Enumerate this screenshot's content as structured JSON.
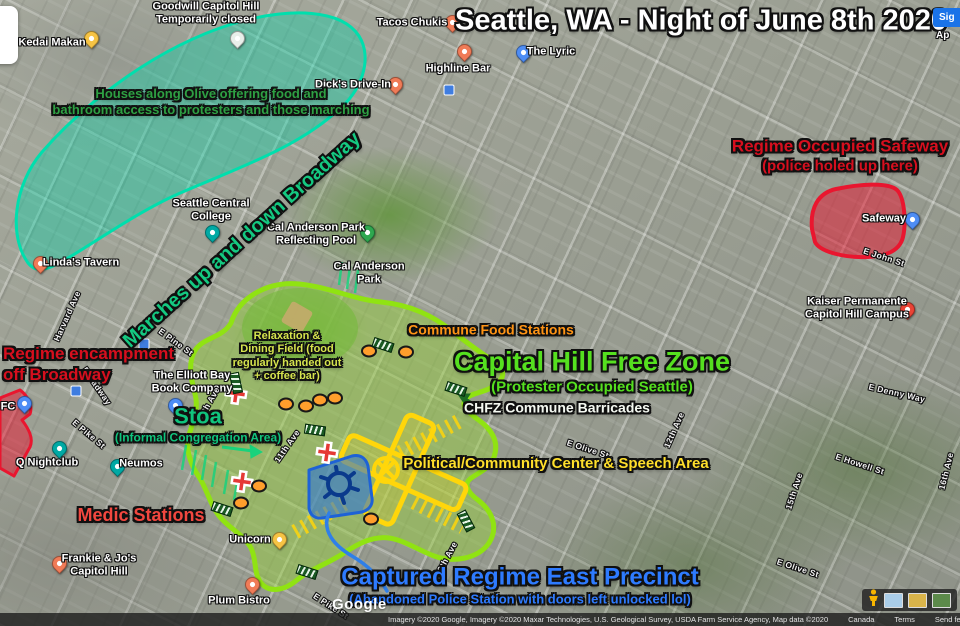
{
  "chrome": {
    "sign_in": "Sig",
    "apps": "Ap"
  },
  "footer": {
    "logo": "Google",
    "attribution": "Imagery ©2020 Google, Imagery ©2020 Maxar Technologies, U.S. Geological Survey, USDA Farm Service Agency, Map data ©2020",
    "region": "Canada",
    "terms": "Terms",
    "feedback": "Send feedback",
    "scale": "50 m"
  },
  "annotations": [
    {
      "id": "main-title",
      "lines": [
        "Seattle, WA - Night of June 8th 2020"
      ],
      "color": "#ffffff",
      "x": 701,
      "y": 21,
      "size": 29,
      "align": "center"
    },
    {
      "id": "houses-olive",
      "lines": [
        "Houses along Olive offering food and",
        "bathroom access to protesters and those marching"
      ],
      "color": "#2ea043",
      "x": 211,
      "y": 102,
      "size": 13,
      "align": "center"
    },
    {
      "id": "marches-broadway",
      "lines": [
        "Marches up and down Broadway"
      ],
      "color": "#14c981",
      "x": 242,
      "y": 240,
      "size": 20,
      "align": "center",
      "rotate": -42
    },
    {
      "id": "regime-safeway",
      "lines": [
        "Regime Occupied Safeway",
        "(police holed up here)"
      ],
      "color": "#d70f1e",
      "x": 840,
      "y": 156,
      "size": 17,
      "size2": 15,
      "align": "center"
    },
    {
      "id": "regime-encampment",
      "lines": [
        "Regime encampment",
        "off Broadway"
      ],
      "color": "#d70f1e",
      "x": 3,
      "y": 344,
      "size": 17,
      "align": "left"
    },
    {
      "id": "chfz-title",
      "lines": [
        "Capital Hill Free Zone",
        "(Protester Occupied Seattle)"
      ],
      "color": "#55e01f",
      "x": 592,
      "y": 371,
      "size": 27,
      "size2": 15,
      "align": "center"
    },
    {
      "id": "commune-food",
      "lines": [
        "Commune Food Stations"
      ],
      "color": "#ff9415",
      "x": 491,
      "y": 330,
      "size": 14,
      "align": "center"
    },
    {
      "id": "chfz-barricades",
      "lines": [
        "CHFZ Commune Barricades"
      ],
      "color": "#f5f9f2",
      "x": 557,
      "y": 408,
      "size": 14,
      "align": "center"
    },
    {
      "id": "relaxation-field",
      "lines": [
        "Relaxation &",
        "Dining Field (food",
        "regularly handed out",
        "+ coffee bar)"
      ],
      "color": "#d6e44e",
      "x": 287,
      "y": 357,
      "size": 11,
      "align": "center"
    },
    {
      "id": "stoa",
      "lines": [
        "Stoa",
        "(Informal Congregation Area)"
      ],
      "color": "#10c47d",
      "x": 198,
      "y": 424,
      "size": 22,
      "size2": 12,
      "align": "center"
    },
    {
      "id": "medic-stations",
      "lines": [
        "Medic Stations"
      ],
      "color": "#f2473f",
      "x": 141,
      "y": 516,
      "size": 18,
      "align": "center"
    },
    {
      "id": "speech-area",
      "lines": [
        "Political/Community Center & Speech Area"
      ],
      "color": "#ffdf2b",
      "x": 556,
      "y": 464,
      "size": 15,
      "align": "center"
    },
    {
      "id": "captured-precinct",
      "lines": [
        "Captured Regime East Precinct",
        "(Abandoned Police Station with doors left unlocked lol)"
      ],
      "color": "#2e7bff",
      "x": 520,
      "y": 585,
      "size": 24,
      "size2": 13,
      "align": "center"
    }
  ],
  "pin_colors": {
    "orange": "#F07B57",
    "yellow": "#F6C344",
    "teal": "#00A9A4",
    "blue": "#4E8DF5",
    "green": "#2EA84F",
    "red": "#EA4335",
    "white": "#E9EFEA"
  },
  "places": [
    {
      "name": "Kedai Makan",
      "pin": "yellow",
      "pin_xy": [
        90,
        46
      ],
      "txt_xy": [
        52,
        43
      ]
    },
    {
      "name": "Goodwill Capitol Hill\nTemporarily closed",
      "pin": "white",
      "pin_xy": [
        236,
        46
      ],
      "txt_xy": [
        206,
        13
      ]
    },
    {
      "name": "Tacos Chukis",
      "pin": "orange",
      "pin_xy": [
        451,
        30
      ],
      "txt_xy": [
        412,
        23
      ]
    },
    {
      "name": "The Lyric",
      "pin": "blue",
      "pin_xy": [
        522,
        60
      ],
      "txt_xy": [
        551,
        52
      ]
    },
    {
      "name": "Highline Bar",
      "pin": "orange",
      "pin_xy": [
        463,
        59
      ],
      "txt_xy": [
        458,
        69
      ]
    },
    {
      "name": "Dick's Drive-In",
      "pin": "orange",
      "pin_xy": [
        394,
        92
      ],
      "txt_xy": [
        353,
        85
      ]
    },
    {
      "name": "Linda's Tavern",
      "pin": "orange",
      "pin_xy": [
        39,
        271
      ],
      "txt_xy": [
        81,
        263
      ]
    },
    {
      "name": "Seattle Central\nCollege",
      "pin": "teal",
      "pin_xy": [
        211,
        240
      ],
      "txt_xy": [
        211,
        210
      ]
    },
    {
      "name": "Cal Anderson Park\nReflecting Pool",
      "pin": "green",
      "pin_xy": [
        366,
        240
      ],
      "txt_xy": [
        316,
        234
      ]
    },
    {
      "name": "Cal Anderson\nPark",
      "pin": null,
      "txt_xy": [
        369,
        273
      ]
    },
    {
      "name": "Safeway",
      "pin": "blue",
      "pin_xy": [
        911,
        227
      ],
      "txt_xy": [
        884,
        219
      ]
    },
    {
      "name": "Kaiser Permanente\nCapitol Hill Campus",
      "pin": "red",
      "pin_xy": [
        906,
        317
      ],
      "txt_xy": [
        857,
        308
      ]
    },
    {
      "name": "The Elliott Bay\nBook Company",
      "pin": "blue",
      "pin_xy": [
        174,
        413
      ],
      "txt_xy": [
        192,
        382
      ]
    },
    {
      "name": "FC",
      "pin": "blue",
      "pin_xy": [
        23,
        411
      ],
      "txt_xy": [
        8,
        407
      ]
    },
    {
      "name": "Q Nightclub",
      "pin": "teal",
      "pin_xy": [
        58,
        456
      ],
      "txt_xy": [
        47,
        463
      ]
    },
    {
      "name": "Neumos",
      "pin": "teal",
      "pin_xy": [
        116,
        474
      ],
      "txt_xy": [
        141,
        464
      ]
    },
    {
      "name": "Unicorn",
      "pin": "yellow",
      "pin_xy": [
        278,
        547
      ],
      "txt_xy": [
        250,
        540
      ]
    },
    {
      "name": "Frankie & Jo's\nCapitol Hill",
      "pin": "orange",
      "pin_xy": [
        58,
        571
      ],
      "txt_xy": [
        99,
        565
      ]
    },
    {
      "name": "Plum Bistro",
      "pin": "orange",
      "pin_xy": [
        251,
        592
      ],
      "txt_xy": [
        239,
        601
      ]
    }
  ],
  "streets": [
    {
      "name": "E Denny Way",
      "x": 897,
      "y": 393,
      "rot": 13
    },
    {
      "name": "E Howell St",
      "x": 860,
      "y": 464,
      "rot": 18
    },
    {
      "name": "15th Ave",
      "x": 794,
      "y": 491,
      "rot": -72
    },
    {
      "name": "16th Ave",
      "x": 946,
      "y": 471,
      "rot": -76
    },
    {
      "name": "E Olive St",
      "x": 798,
      "y": 568,
      "rot": 18
    },
    {
      "name": "E Olive St",
      "x": 588,
      "y": 449,
      "rot": 18
    },
    {
      "name": "E John St",
      "x": 884,
      "y": 257,
      "rot": 18
    },
    {
      "name": "E Pike St",
      "x": 331,
      "y": 606,
      "rot": 33
    },
    {
      "name": "E Pike St",
      "x": 89,
      "y": 434,
      "rot": 40
    },
    {
      "name": "E Pine St",
      "x": 176,
      "y": 342,
      "rot": 36
    },
    {
      "name": "Broadway",
      "x": 97,
      "y": 386,
      "rot": 55
    },
    {
      "name": "11th Ave",
      "x": 287,
      "y": 446,
      "rot": -55
    },
    {
      "name": "12th Ave",
      "x": 674,
      "y": 430,
      "rot": -66
    },
    {
      "name": "13th Ave",
      "x": 446,
      "y": 559,
      "rot": -62
    },
    {
      "name": "10th Ave",
      "x": 208,
      "y": 404,
      "rot": -60
    },
    {
      "name": "Harvard Ave",
      "x": 67,
      "y": 316,
      "rot": -66
    }
  ],
  "markers": {
    "medic": [
      [
        236,
        396
      ],
      [
        242,
        484
      ],
      [
        327,
        455
      ]
    ],
    "food": [
      [
        369,
        351
      ],
      [
        406,
        352
      ],
      [
        286,
        404
      ],
      [
        306,
        406
      ],
      [
        320,
        400
      ],
      [
        335,
        398
      ],
      [
        259,
        486
      ],
      [
        241,
        503
      ],
      [
        371,
        519
      ]
    ],
    "barricade": [
      [
        383,
        345,
        18
      ],
      [
        456,
        389,
        18
      ],
      [
        315,
        430,
        8
      ],
      [
        222,
        509,
        18
      ],
      [
        466,
        521,
        62
      ],
      [
        307,
        572,
        18
      ],
      [
        236,
        383,
        78
      ]
    ],
    "transit": [
      [
        449,
        90
      ],
      [
        144,
        344
      ],
      [
        76,
        391
      ]
    ]
  },
  "marker_colors": {
    "medic": "#E53935",
    "food": "#FF9E2C",
    "barricade": "#1A5A23",
    "transit": "#3F7DE0"
  },
  "zone_colors": {
    "goodwill_fill": "rgba(0,214,168,0.38)",
    "goodwill_stroke": "#00DFAD",
    "chfz_fill": "rgba(151,211,58,0.45)",
    "chfz_stroke": "#90E312",
    "field_fill": "rgba(114,186,56,0.55)",
    "red_fill": "rgba(233,22,48,0.5)",
    "red_stroke": "#E9162F",
    "precinct_fill": "rgba(36,112,226,0.55)",
    "precinct_stroke": "#1E62D6",
    "speech_fill": "rgba(255,214,10,0.18)",
    "speech_stroke": "#FFD60A",
    "hatch_stroke": "#19D27C",
    "hatch_fill": "#19D27C",
    "darkgreen_stroke": "#1E6B25",
    "darkgreen_fill": "#1E6B25",
    "route_stroke": "#2F7FE8",
    "doodle_stroke": "#0A3A8C",
    "diamond_fill": "#C9A96E"
  }
}
